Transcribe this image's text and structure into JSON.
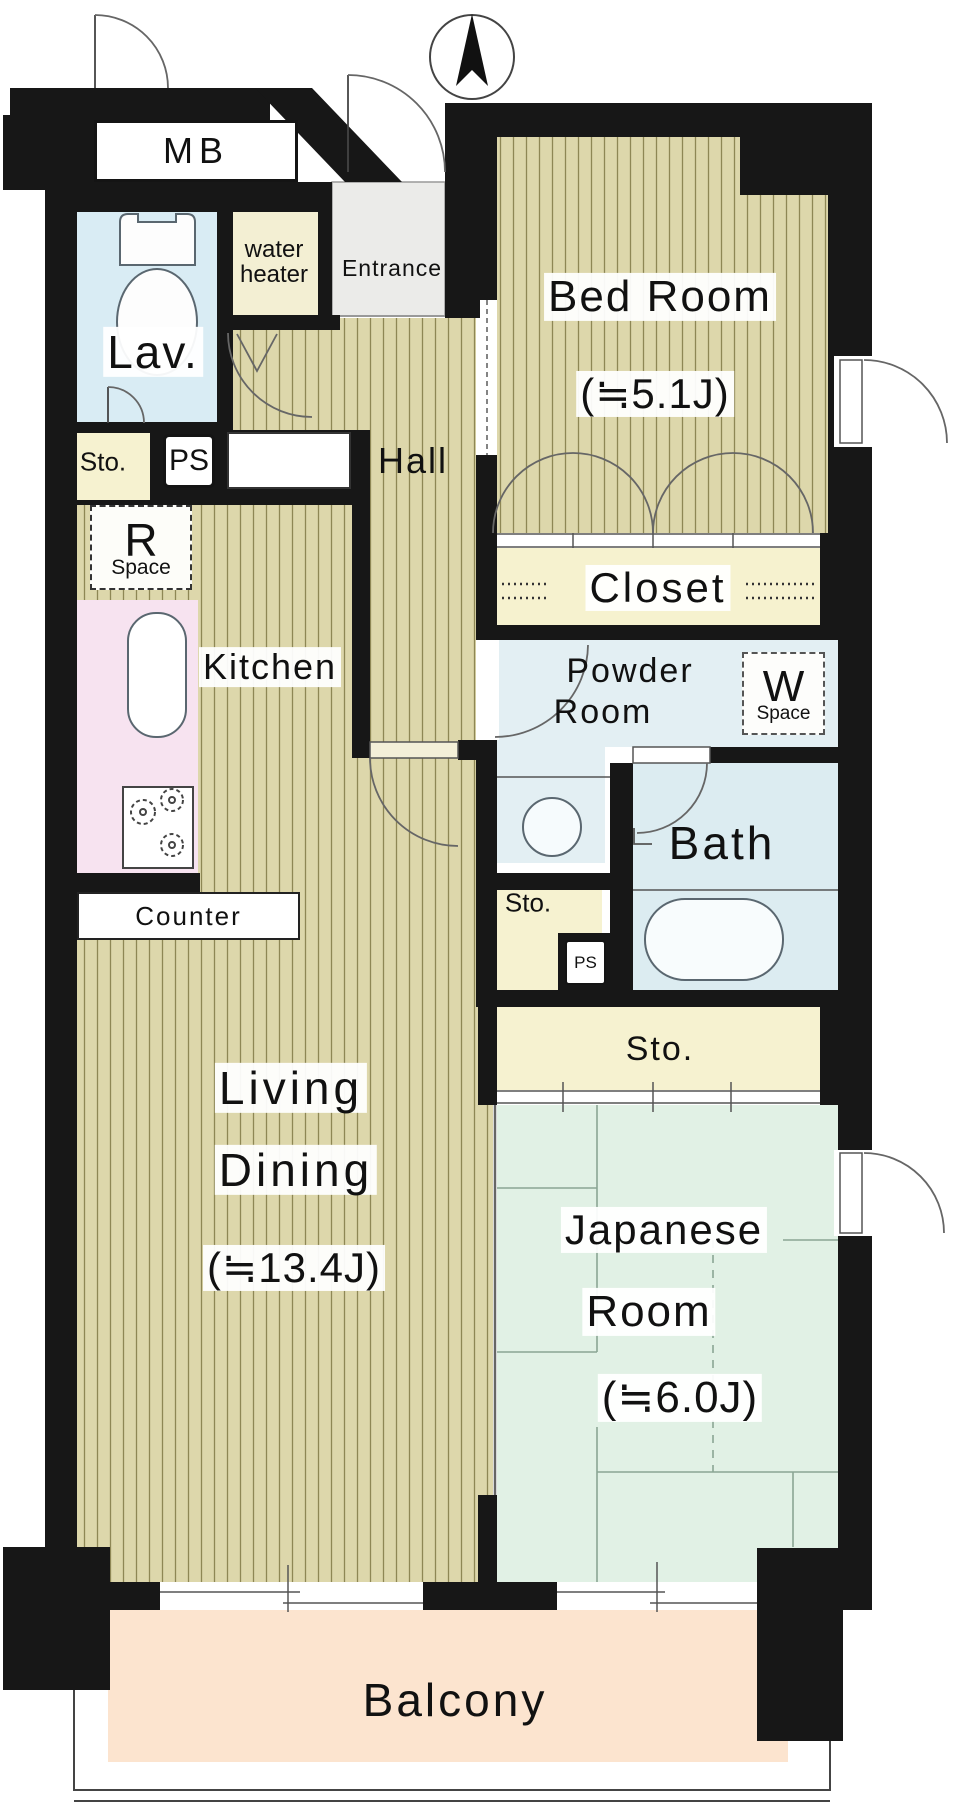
{
  "rooms": {
    "meter_box": {
      "name": "MB"
    },
    "lavatory": {
      "name": "Lav."
    },
    "water_heater": {
      "line1": "water",
      "line2": "heater"
    },
    "entrance": {
      "name": "Entrance"
    },
    "bedroom": {
      "name": "Bed Room",
      "area": "(≒5.1J)"
    },
    "storage_top": {
      "name": "Sto."
    },
    "pipe_shaft_top": {
      "name": "PS"
    },
    "hall": {
      "name": "Hall"
    },
    "refrigerator_space": {
      "letter": "R",
      "word": "Space"
    },
    "kitchen": {
      "name": "Kitchen"
    },
    "counter": {
      "name": "Counter"
    },
    "closet": {
      "name": "Closet"
    },
    "powder_room": {
      "line1": "Powder",
      "line2": "Room"
    },
    "washer_space": {
      "letter": "W",
      "word": "Space"
    },
    "bath": {
      "name": "Bath"
    },
    "storage_mid": {
      "name": "Sto."
    },
    "pipe_shaft_mid": {
      "name": "PS"
    },
    "storage_strip": {
      "name": "Sto."
    },
    "living_dining": {
      "line1": "Living",
      "line2": "Dining",
      "area": "(≒13.4J)"
    },
    "japanese_room": {
      "line1": "Japanese",
      "line2": "Room",
      "area": "(≒6.0J)"
    },
    "balcony": {
      "name": "Balcony"
    }
  },
  "colors": {
    "wall": "#171717",
    "floor_base": "#ddd7ab",
    "floor_stripe": "#8e8755",
    "lavatory": "#d9ecf4",
    "water_heater": "#f3efd3",
    "entrance": "#ebebe9",
    "storage": "#f6f2d0",
    "closet": "#f6f2cf",
    "powder_room": "#e3eff3",
    "bath": "#dcecf1",
    "japanese_room": "#e1f1e5",
    "balcony": "#fce4cf",
    "kitchen_counter": "#f7e3f0"
  }
}
